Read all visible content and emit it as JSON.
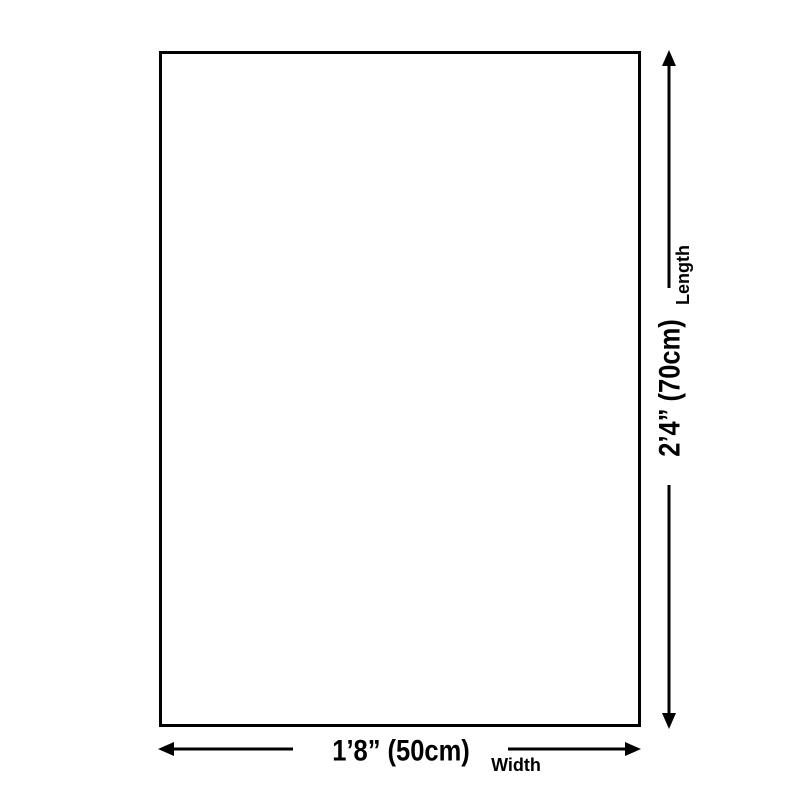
{
  "diagram": {
    "background_color": "#ffffff",
    "line_color": "#000000",
    "product": {
      "shape": "rectangle",
      "fill_color": "#ffffff",
      "border_color": "#000000"
    },
    "length": {
      "value": "2’4” (70cm)",
      "label": "Length"
    },
    "width": {
      "value": "1’8” (50cm)",
      "label": "Width"
    }
  }
}
